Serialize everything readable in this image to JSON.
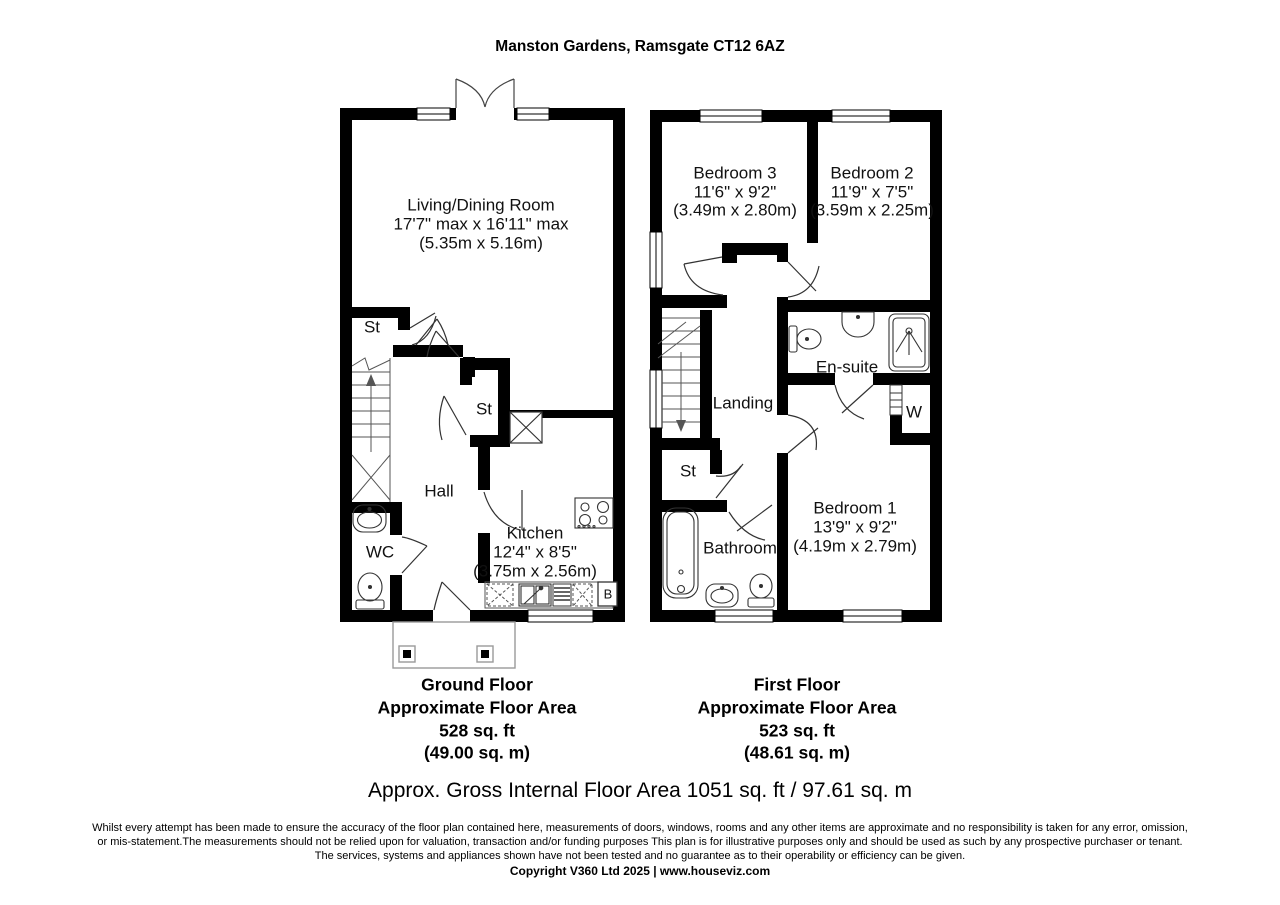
{
  "title": "Manston Gardens, Ramsgate CT12 6AZ",
  "ground_floor": {
    "caption": [
      "Ground Floor",
      "Approximate Floor Area",
      "528 sq. ft",
      "(49.00 sq. m)"
    ],
    "rooms": {
      "living": {
        "name": "Living/Dining Room",
        "imperial": "17'7\" max x 16'11\" max",
        "metric": "(5.35m x 5.16m)"
      },
      "store1": {
        "name": "St"
      },
      "store2": {
        "name": "St"
      },
      "hall": {
        "name": "Hall"
      },
      "wc": {
        "name": "WC"
      },
      "kitchen": {
        "name": "Kitchen",
        "imperial": "12'4\" x 8'5\"",
        "metric": "(3.75m x 2.56m)"
      },
      "boiler": {
        "name": "B"
      }
    }
  },
  "first_floor": {
    "caption": [
      "First Floor",
      "Approximate Floor Area",
      "523 sq. ft",
      "(48.61 sq. m)"
    ],
    "rooms": {
      "bedroom3": {
        "name": "Bedroom 3",
        "imperial": "11'6\" x 9'2\"",
        "metric": "(3.49m x 2.80m)"
      },
      "bedroom2": {
        "name": "Bedroom 2",
        "imperial": "11'9\" x 7'5\"",
        "metric": "(3.59m x 2.25m)"
      },
      "ensuite": {
        "name": "En-suite"
      },
      "wardrobe": {
        "name": "W"
      },
      "landing": {
        "name": "Landing"
      },
      "store": {
        "name": "St"
      },
      "bathroom": {
        "name": "Bathroom"
      },
      "bedroom1": {
        "name": "Bedroom 1",
        "imperial": "13'9\" x 9'2\"",
        "metric": "(4.19m x 2.79m)"
      }
    }
  },
  "summary": "Approx. Gross Internal Floor Area 1051 sq. ft / 97.61 sq. m",
  "disclaimer": [
    "Whilst every attempt has been made to ensure the accuracy of the floor plan contained here, measurements of doors, windows, rooms and any other items are approximate and no responsibility is taken for any error, omission,",
    "or mis-statement.The measurements should not be relied upon for valuation, transaction and/or funding purposes This plan is for illustrative purposes only and should be used as such by any prospective purchaser or tenant.",
    "The services, systems and appliances shown have not been tested and no guarantee as to their operability or efficiency can be given."
  ],
  "copyright": "Copyright V360 Ltd 2025 | www.houseviz.com",
  "colors": {
    "wall": "#000000",
    "background": "#ffffff",
    "porch_outline": "#9a9a9a"
  }
}
